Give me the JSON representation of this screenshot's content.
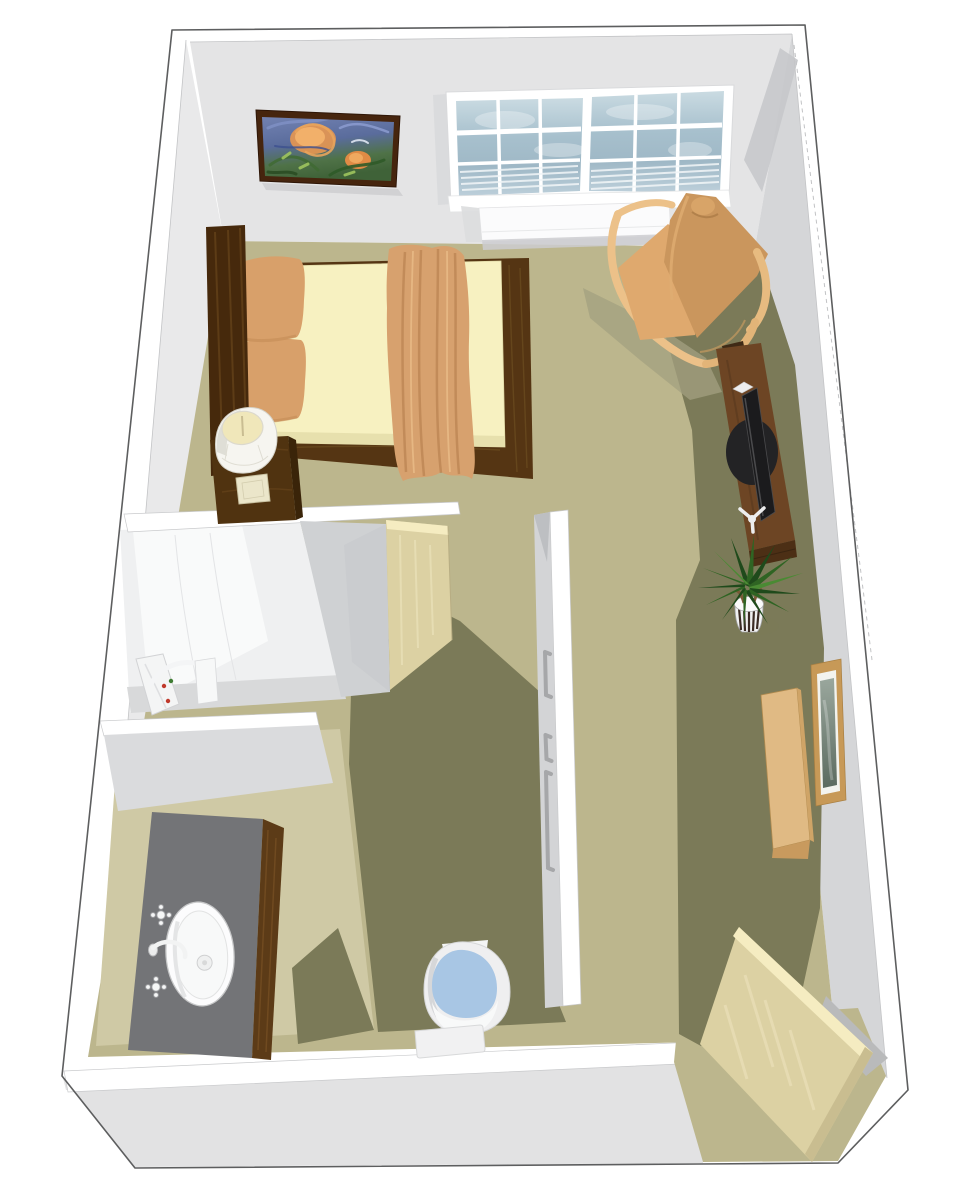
{
  "scene": {
    "kind": "3d-floorplan-render",
    "description": "Bird's-eye 3D rendering of a studio apartment: sleeping/living area with bed, armchair, TV console, potted plant and sideboard; bathroom with roll-in shower, vanity sink and toilet; open entry door at lower right",
    "rooms": [
      "main-room",
      "shower-room",
      "vanity-area",
      "toilet-nook",
      "entry"
    ],
    "objects": [
      "painting",
      "double-window",
      "radiator-shelf",
      "bed",
      "pillows",
      "throw-blanket",
      "headboard",
      "nightstand",
      "table-lamp",
      "armchair",
      "tv-console",
      "television",
      "potted-plant",
      "sideboard",
      "picture-frame",
      "bathroom-door",
      "entry-door",
      "shower-fixture",
      "shower-seat",
      "grab-bars",
      "vanity-counter",
      "sink",
      "faucets",
      "toilet"
    ]
  },
  "palette": {
    "outer_line": "#5d5e5f",
    "wall_white": "#ffffff",
    "face_top": "#e4e4e5",
    "face_right": "#d5d6d8",
    "face_right_dark": "#c7c8cb",
    "face_left": "#e9e9ea",
    "face_ext_bottom": "#e2e2e3",
    "partition_face": "#d3d4d6",
    "bath_block_face": "#cfd1d3",
    "floor_main": "#bcb68d",
    "floor_shadow": "#7b7a58",
    "floor_bath": "#cfc9a5",
    "floor_shower": "#d8d9da",
    "shower_wall": "#eff0f1",
    "window_pane": "#a7bfcc",
    "window_frame": "#ffffff",
    "radiator": "#fbfbfc",
    "painting_frame": "#46250e",
    "bed_wood": "#553513",
    "bed_wood_light": "#7a5a28",
    "headboard": "#46290c",
    "mattress": "#f7f1c1",
    "mattress_side": "#e7e0ad",
    "pillow": "#d8a06a",
    "pillow_dark": "#bf8851",
    "blanket": "#d7a16e",
    "blanket_dark": "#b07a48",
    "nightstand": "#503310",
    "lamp_shade": "#f6f5f0",
    "lamp_shade_shadow": "#dddbd3",
    "lamp_base": "#ebe6ca",
    "chair_wood": "#ecc189",
    "chair_back": "#ca965d",
    "chair_cushion": "#dfa96e",
    "tv_wood": "#6d4524",
    "tv_wood_dark": "#4c2f15",
    "tv_black": "#1b1b1d",
    "tv_mount": "#ededee",
    "plant_dark": "#1f4a1b",
    "plant_mid": "#2f6423",
    "plant_light": "#4a8a33",
    "pot_white": "#f1f1f2",
    "pot_stripe": "#3b2b24",
    "trunk": "#7a5a38",
    "sideboard": "#e0ba84",
    "sideboard_dark": "#c89a5e",
    "pframe_wood": "#c79957",
    "pframe_mat": "#f3f3ee",
    "door_face": "#dcd1a3",
    "door_light": "#eae0b8",
    "door_edge": "#f5ecc1",
    "door_dark": "#c9bd90",
    "counter": "#737477",
    "cabinet_wood": "#5c3b17",
    "sink_white": "#fcfcfd",
    "fixture_line": "#9c9da0",
    "toilet_white": "#efeff0",
    "toilet_blue": "#a8c6e4",
    "toilet_gray": "#d0d1d3",
    "grab_bar": "#a6a7a9",
    "shadow_soft": "#a3a080"
  }
}
